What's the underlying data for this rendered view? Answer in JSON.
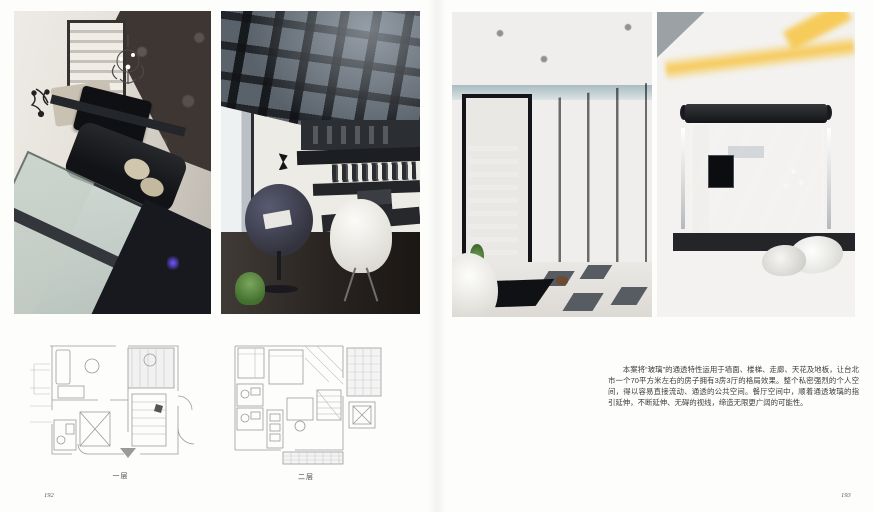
{
  "spread": {
    "left_page_number": "192",
    "right_page_number": "193"
  },
  "plans": {
    "level1_label": "一层",
    "level2_label": "二层"
  },
  "article": {
    "body": "本案将“玻璃”的通透特性运用于墙面、楼梯、走廊、天花及地板，让台北市一个70平方米左右的房子拥有3房3厅的格局效果。整个私密强烈的个人空间，得以容易直接流动、通透的公共空间。餐厅空间中，顺着通透玻璃的指引延伸，不断延伸、无碍的视线，缔造无限更广阔的可能性。"
  },
  "colors": {
    "cove_light_yellow": "#f7c648",
    "glass_green": "#98aaa3",
    "wardrobe_brown": "#332d27",
    "accent_purple_glow": "#6a4df0"
  }
}
